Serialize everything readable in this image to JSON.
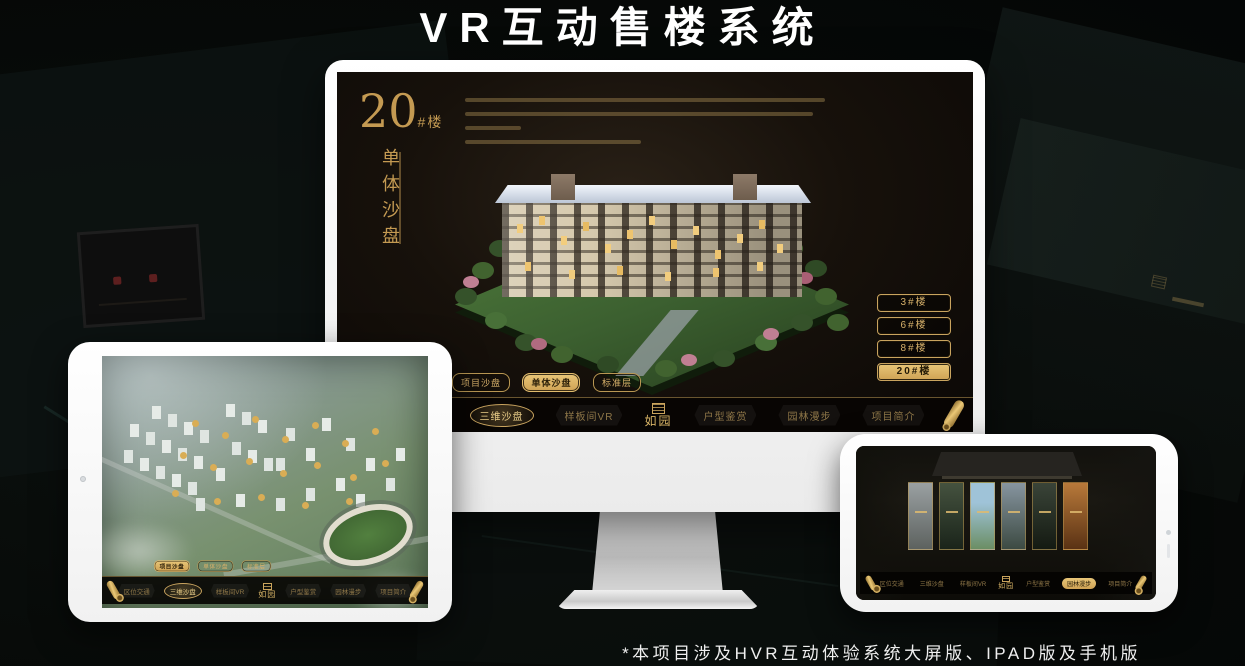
{
  "page": {
    "title": "VR互动售楼系统",
    "footnote": "*本项目涉及HVR互动体验系统大屏版、IPAD版及手机版"
  },
  "colors": {
    "gold": "#C9A45F",
    "gold_bright": "#E8C678",
    "screen_background": "#17110B",
    "nav_text": "#8F7748"
  },
  "brand": {
    "logo_text": "如园"
  },
  "monitor": {
    "panel": {
      "number": "20",
      "number_suffix": "#楼",
      "subtitle": "单体沙盘"
    },
    "building_buttons": [
      {
        "label": "3#楼",
        "active": false
      },
      {
        "label": "6#楼",
        "active": false
      },
      {
        "label": "8#楼",
        "active": false
      },
      {
        "label": "20#楼",
        "active": true
      }
    ],
    "sub_tabs": [
      {
        "label": "项目沙盘",
        "active": false
      },
      {
        "label": "单体沙盘",
        "active": true
      },
      {
        "label": "标准层",
        "active": false
      }
    ],
    "nav_items": [
      {
        "label": "区位交通",
        "active": false
      },
      {
        "label": "三维沙盘",
        "active": true
      },
      {
        "label": "样板间VR",
        "active": false
      },
      {
        "label": "户型鉴赏",
        "active": false
      },
      {
        "label": "园林漫步",
        "active": false
      },
      {
        "label": "项目简介",
        "active": false
      }
    ]
  },
  "tablet": {
    "sub_tabs": [
      {
        "label": "项目沙盘",
        "active": true
      },
      {
        "label": "单体沙盘",
        "active": false
      },
      {
        "label": "标准层",
        "active": false
      }
    ],
    "nav_items": [
      {
        "label": "区位交通",
        "active": false
      },
      {
        "label": "三维沙盘",
        "active": true
      },
      {
        "label": "样板间VR",
        "active": false
      },
      {
        "label": "户型鉴赏",
        "active": false
      },
      {
        "label": "园林漫步",
        "active": false
      },
      {
        "label": "项目简介",
        "active": false
      }
    ]
  },
  "phone": {
    "nav_items": [
      {
        "label": "区位交通",
        "active": false
      },
      {
        "label": "三维沙盘",
        "active": false
      },
      {
        "label": "样板间VR",
        "active": false
      },
      {
        "label": "户型鉴赏",
        "active": false
      },
      {
        "label": "园林漫步",
        "active": true
      },
      {
        "label": "项目简介",
        "active": false
      }
    ]
  }
}
